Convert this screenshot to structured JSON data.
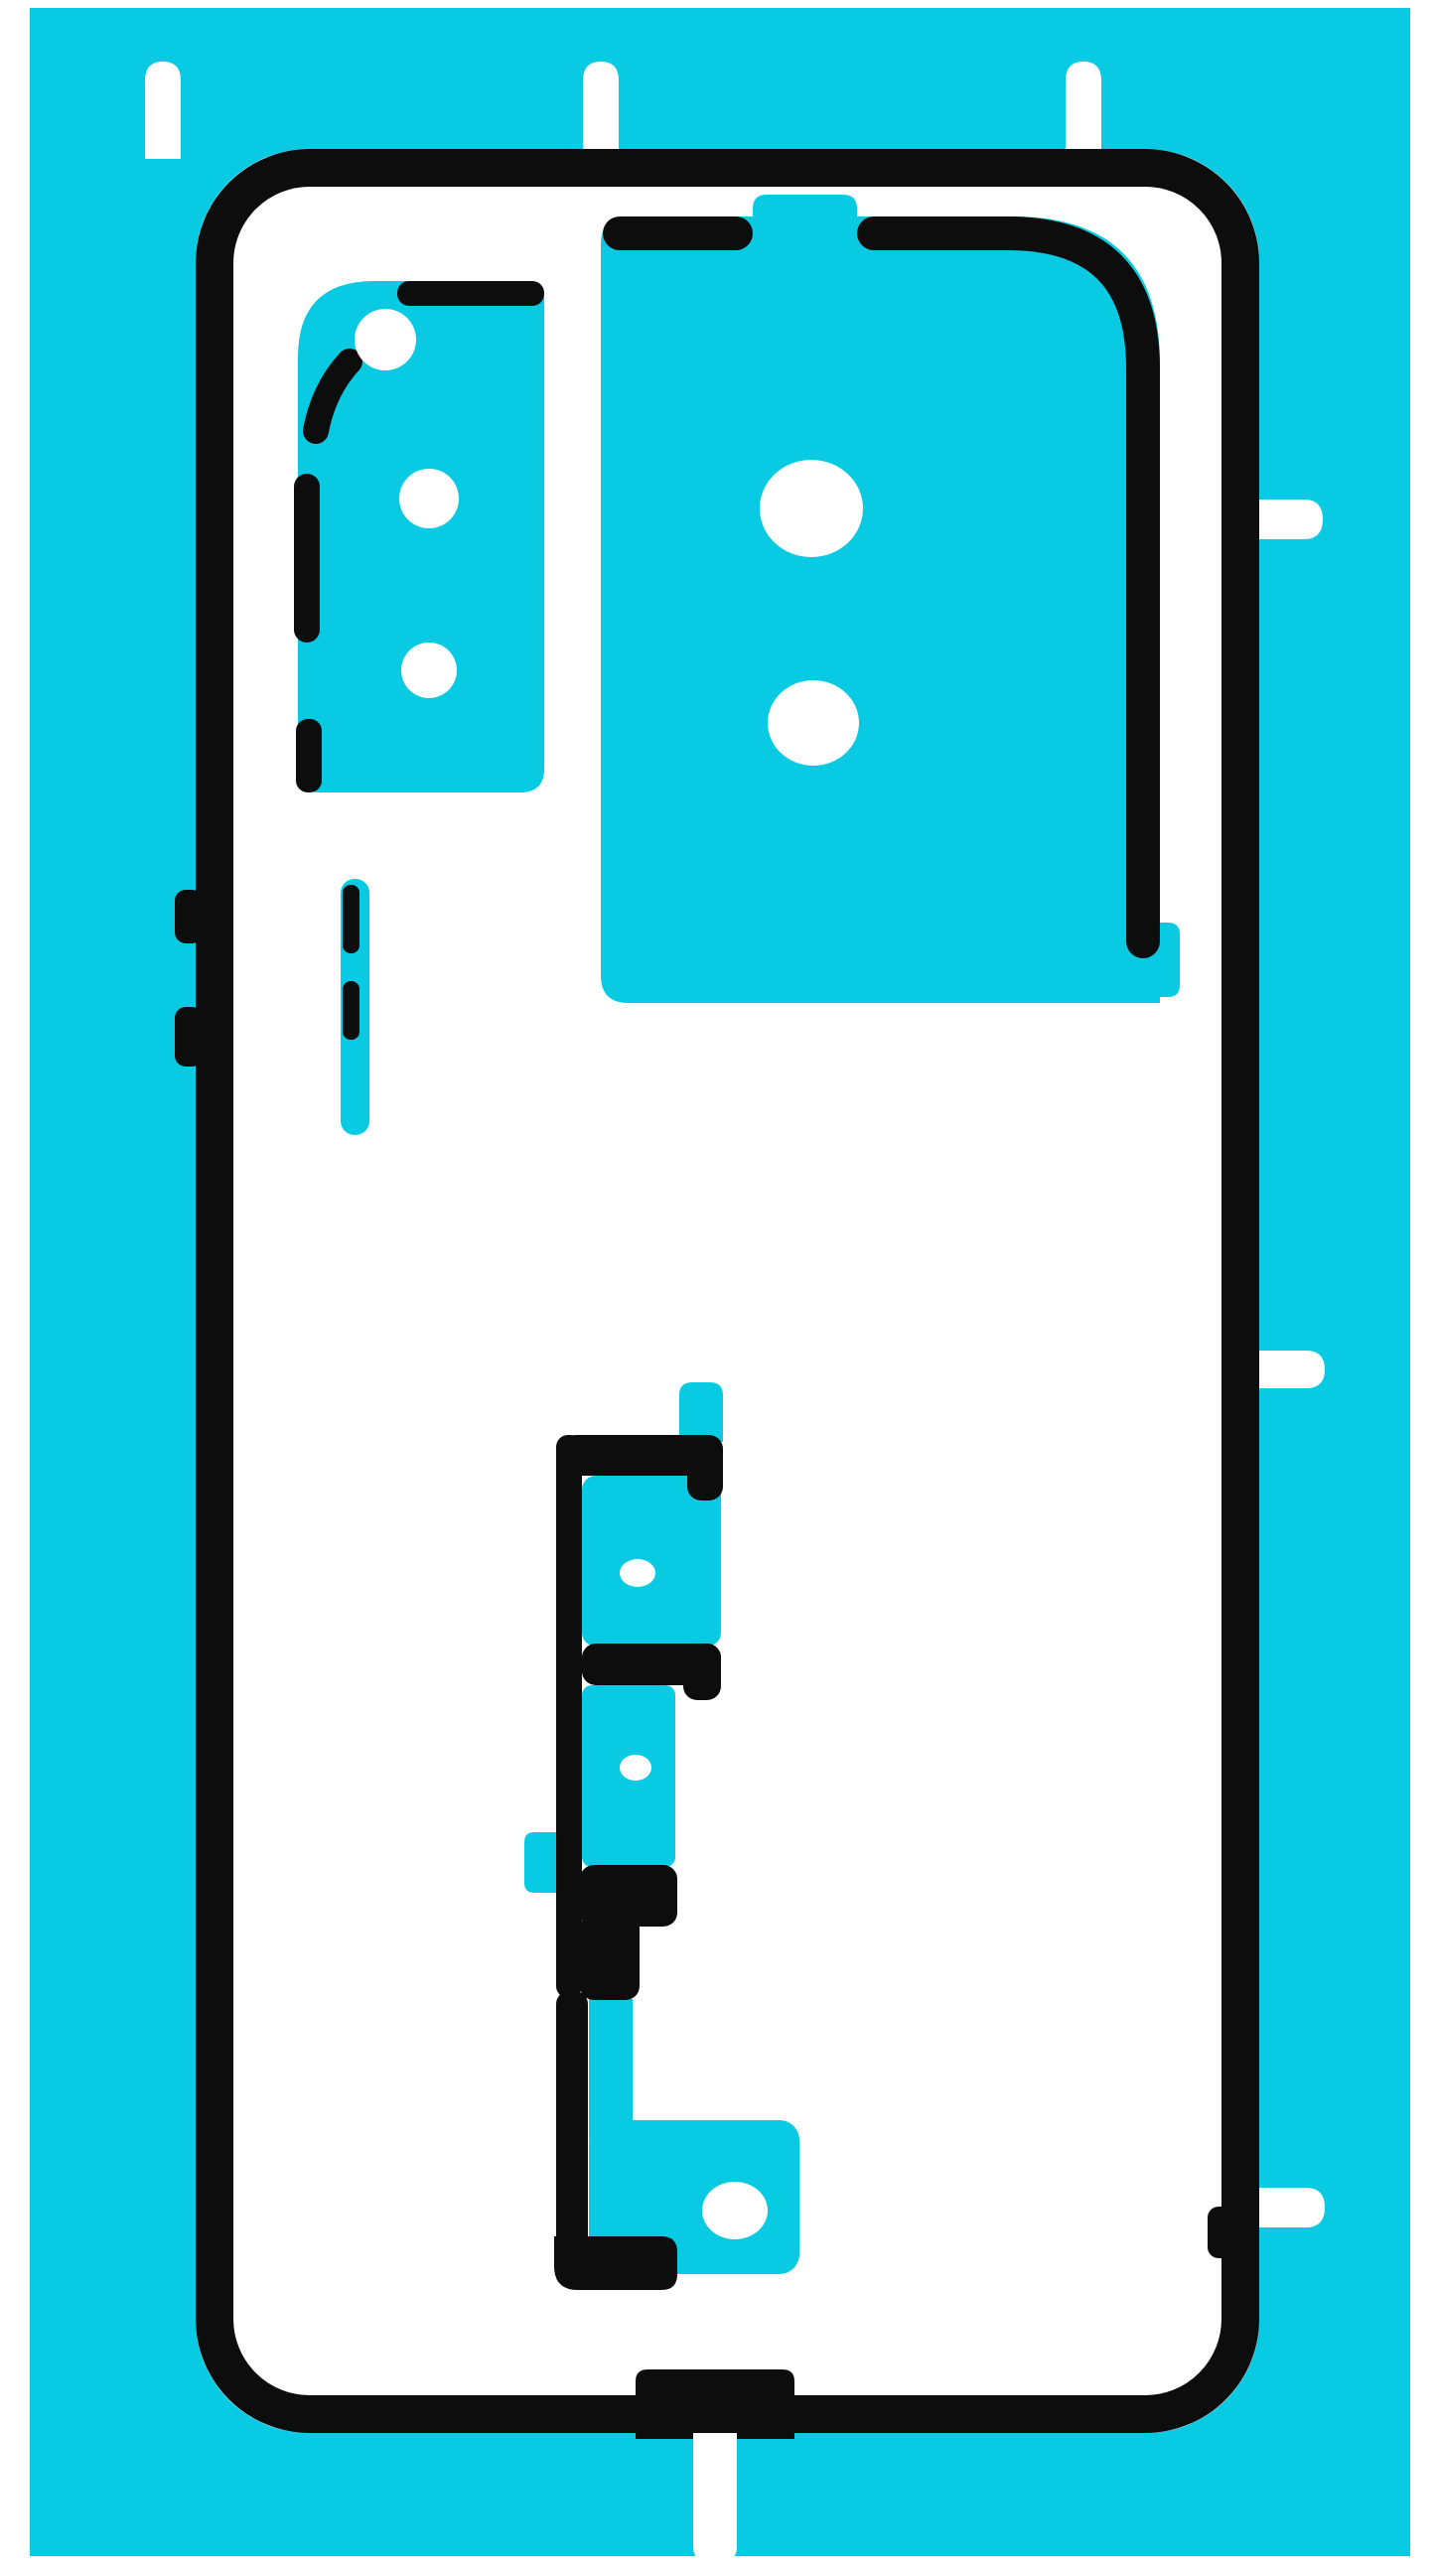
{
  "title": "Phone back cover adhesive sticker sheet (product photo, no text)",
  "colors": {
    "cyan": "#08cbe3",
    "black": "#0d0d0d",
    "white": "#ffffff"
  },
  "photo": {
    "subject": "pre-cut back-cover adhesive film on cyan liner",
    "sheet": "cyan rectangular liner with white paper margin",
    "outline": "thick black rounded-rectangle phone back outline",
    "features": [
      "three white alignment tabs on top edge",
      "three white pull tabs on right edge",
      "one white pull tab at bottom center",
      "left camera adhesive patch with dashed border and two lens holes",
      "large main camera adhesive rectangle with two lens holes, top tab and bottom-right step",
      "small volume-button adhesive strip with two black marks",
      "lower battery-area adhesive set: C-frame with two panels and pin holes, zigzag black spacer, L bracket and slab with large hole"
    ]
  }
}
